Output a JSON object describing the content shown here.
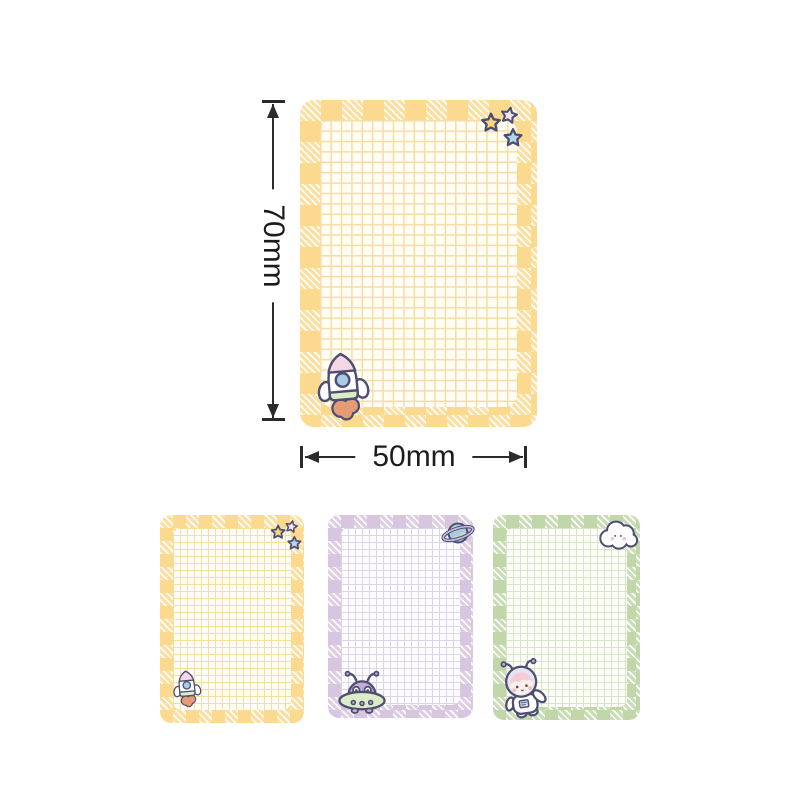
{
  "annotations": {
    "height_label": "70mm",
    "width_label": "50mm"
  },
  "pads": [
    {
      "name": "main yellow memo pad",
      "theme": "yellow",
      "motifs": [
        "stars",
        "rocket"
      ]
    },
    {
      "name": "yellow variant pad",
      "theme": "yellow",
      "motifs": [
        "stars",
        "rocket"
      ]
    },
    {
      "name": "purple variant pad",
      "theme": "purple",
      "motifs": [
        "planet",
        "alien-ufo"
      ]
    },
    {
      "name": "green variant pad",
      "theme": "green",
      "motifs": [
        "cloud",
        "astronaut"
      ]
    }
  ],
  "colors": {
    "label_text": "#1c1c1c",
    "arrow": "#2b2b2b",
    "outline": "#4d4e72",
    "yellow_solid": "#fbd98e",
    "yellow_stripe": "#fcdf9f",
    "yellow_grid": "#f6dda4",
    "yellow_paper": "#fffdf4",
    "purple_solid": "#d8c6e0",
    "purple_stripe": "#ddcee4",
    "purple_grid": "#dbd4ec",
    "purple_paper": "#fdfdfe",
    "green_solid": "#c1d7aa",
    "green_stripe": "#c9dcb5",
    "green_grid": "#d6e4c8",
    "green_paper": "#fcfdf9",
    "star_yellow": "#f6d77d",
    "star_pink": "#f6e4ee",
    "star_blue": "#b4d4ee",
    "rocket_nose": "#f5d7e3",
    "rocket_window": "#a8cbe7",
    "rocket_band": "#dcedc8",
    "rocket_flame": "#e49b76",
    "alien_purple": "#c3add2",
    "alien_green": "#ddecc8",
    "ufo_dot": "#b7a9c9",
    "planet_blue": "#a8cbe3",
    "planet_land": "#c6dfa3",
    "planet_ring": "#c9bee1",
    "hair_pink": "#f3ccd8",
    "face_skin": "#fbf0e7",
    "helmet": "#e7e3f3",
    "badge_blue": "#cfe0f0",
    "cheek": "#f2bac6"
  }
}
